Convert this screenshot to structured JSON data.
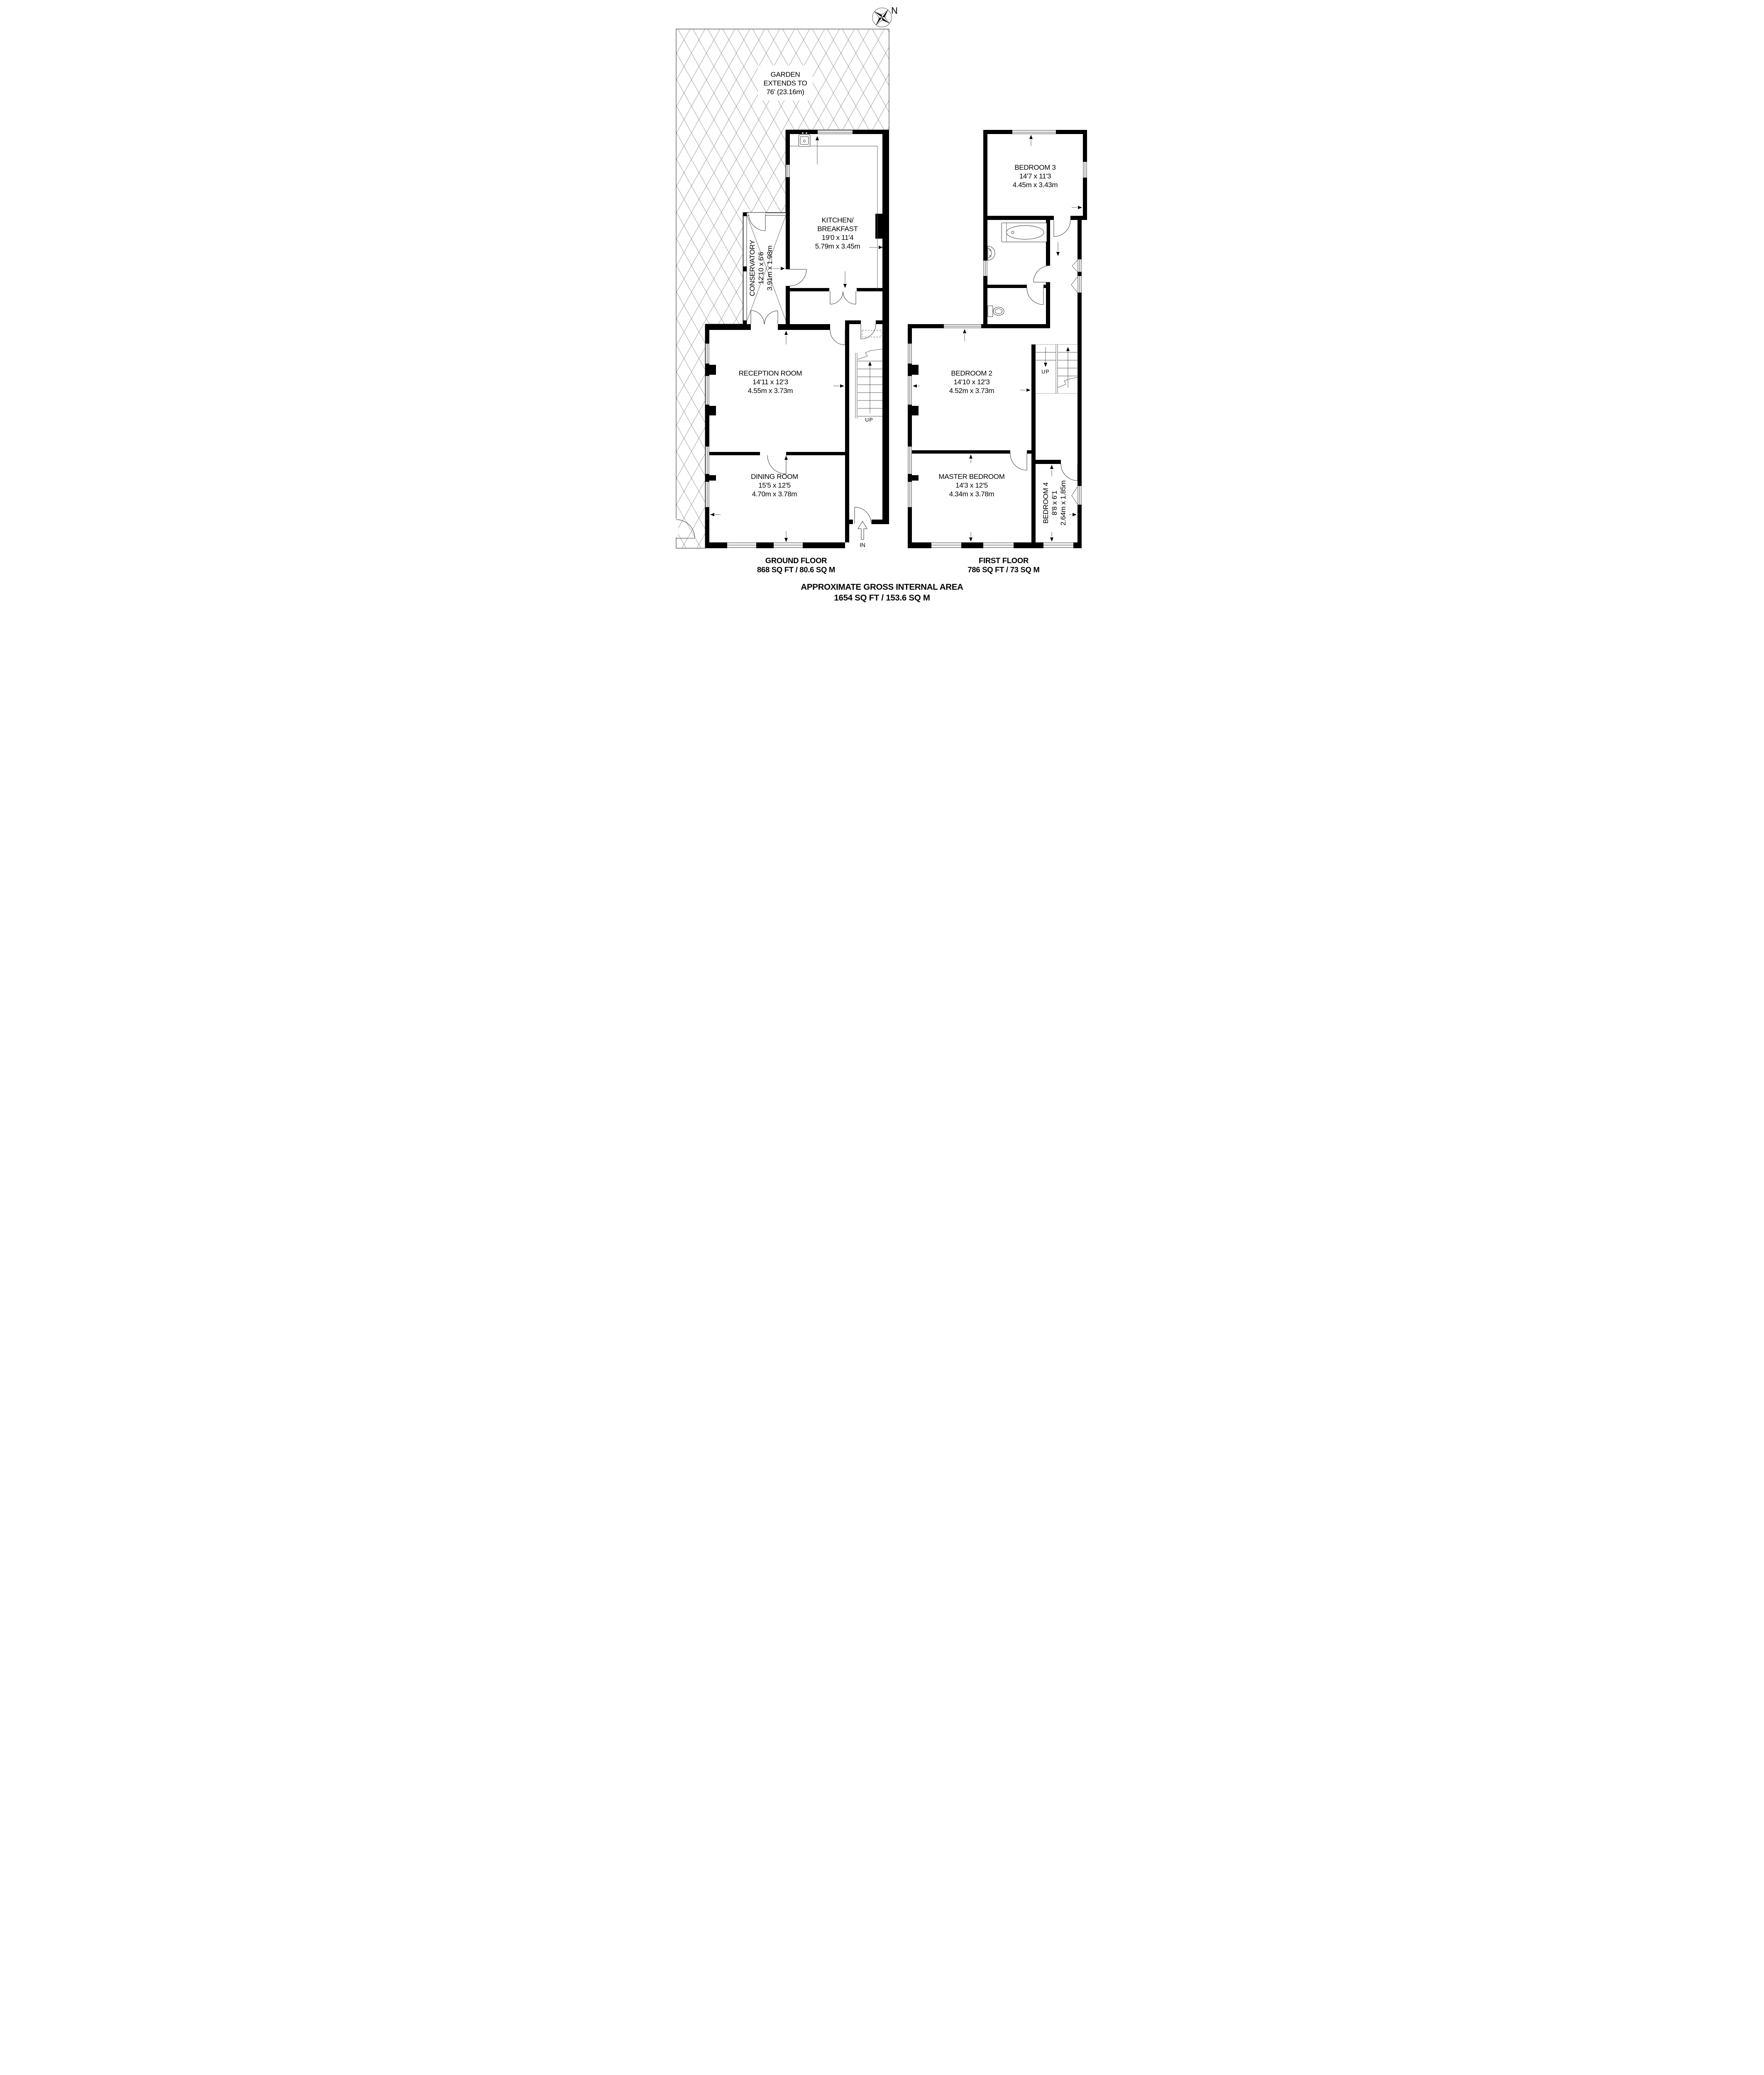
{
  "compass": {
    "north": "N"
  },
  "garden": {
    "line1": "GARDEN",
    "line2": "EXTENDS TO",
    "line3": "76' (23.16m)"
  },
  "rooms": {
    "kitchen": {
      "name1": "KITCHEN/",
      "name2": "BREAKFAST",
      "imperial": "19'0 x 11'4",
      "metric": "5.79m x 3.45m"
    },
    "conservatory": {
      "name": "CONSERVATORY",
      "imperial": "12'10 x 6'6",
      "metric": "3.91m x 1.98m"
    },
    "reception": {
      "name": "RECEPTION ROOM",
      "imperial": "14'11 x 12'3",
      "metric": "4.55m x 3.73m"
    },
    "dining": {
      "name": "DINING ROOM",
      "imperial": "15'5 x 12'5",
      "metric": "4.70m x 3.78m"
    },
    "bedroom3": {
      "name": "BEDROOM 3",
      "imperial": "14'7 x 11'3",
      "metric": "4.45m x 3.43m"
    },
    "bedroom2": {
      "name": "BEDROOM 2",
      "imperial": "14'10 x 12'3",
      "metric": "4.52m x 3.73m"
    },
    "master": {
      "name": "MASTER BEDROOM",
      "imperial": "14'3 x 12'5",
      "metric": "4.34m x 3.78m"
    },
    "bedroom4": {
      "name": "BEDROOM 4",
      "imperial": "8'8 x 6'1",
      "metric": "2.64m x 1.85m"
    }
  },
  "stairs": {
    "ground": {
      "label": "UP"
    },
    "first": {
      "label": "UP"
    }
  },
  "entrance": {
    "label": "IN"
  },
  "floors": {
    "ground": {
      "title": "GROUND FLOOR",
      "area": "868 SQ FT / 80.6 SQ M"
    },
    "first": {
      "title": "FIRST FLOOR",
      "area": "786 SQ FT / 73 SQ M"
    }
  },
  "summary": {
    "line1": "APPROXIMATE GROSS INTERNAL AREA",
    "line2": "1654 SQ FT / 153.6 SQ M"
  },
  "colors": {
    "wall": "#000000",
    "line": "#333333",
    "hatch": "#888888"
  }
}
